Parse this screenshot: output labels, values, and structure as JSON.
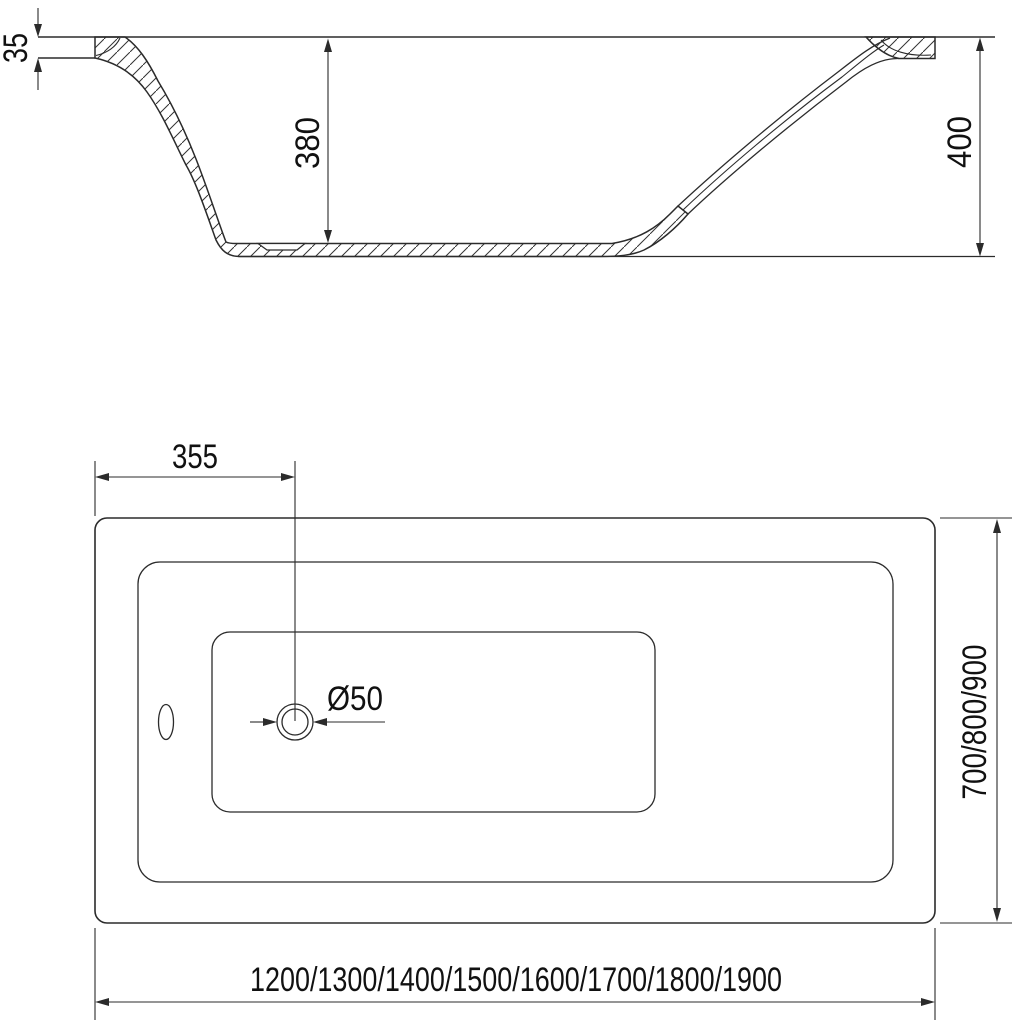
{
  "drawing": {
    "background_color": "#ffffff",
    "line_color": "#2b2b2b",
    "text_color": "#111111",
    "section_view": {
      "rim_thickness_mm": "35",
      "inner_depth_mm": "380",
      "overall_height_mm": "400"
    },
    "plan_view": {
      "drain_offset_mm": "355",
      "drain_diameter": "Ø50",
      "width_options_mm": "700/800/900",
      "length_options_mm": "1200/1300/1400/1500/1600/1700/1800/1900"
    }
  }
}
